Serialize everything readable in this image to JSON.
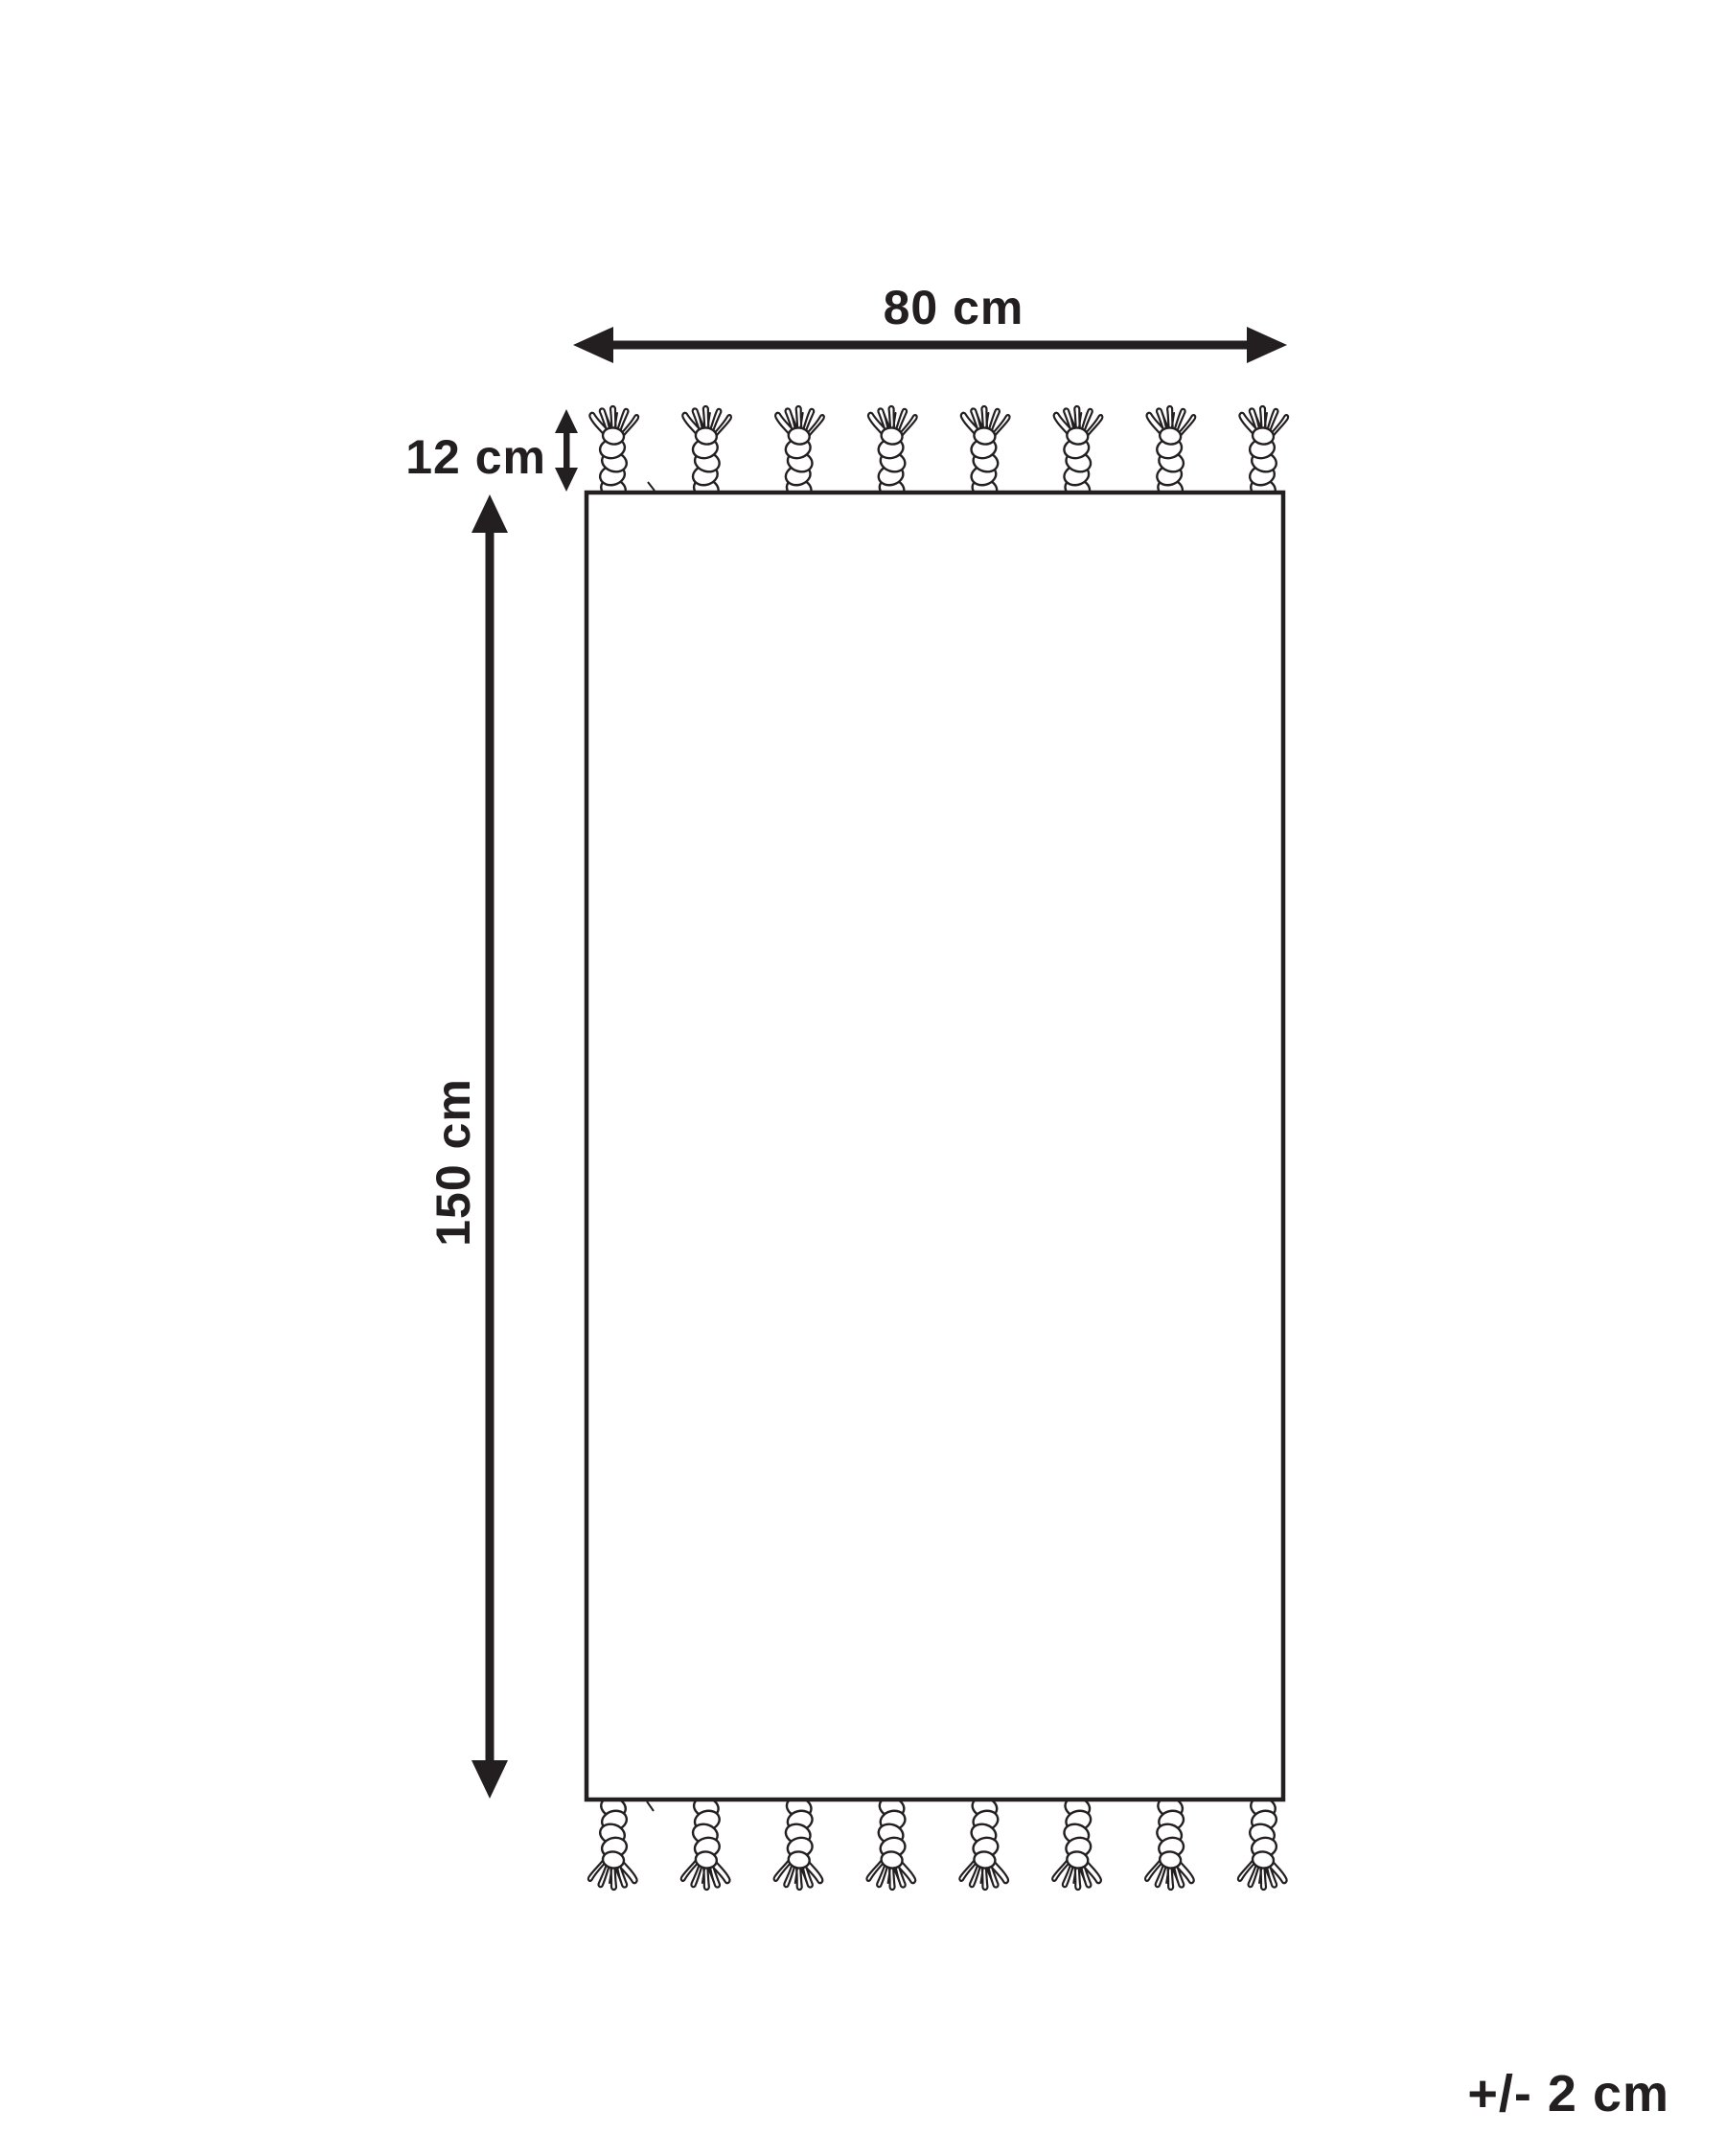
{
  "diagram": {
    "type": "rug-dimension-diagram",
    "labels": {
      "width": "80 cm",
      "fringe": "12 cm",
      "height": "150 cm",
      "tolerance": "+/- 2 cm"
    },
    "dimensions": {
      "width_cm": 80,
      "fringe_cm": 12,
      "height_cm": 150,
      "tolerance_cm": 2
    },
    "tassels": {
      "top_count": 8,
      "bottom_count": 8
    },
    "colors": {
      "ink": "#231f20",
      "background": "#ffffff",
      "rug_fill": "#ffffff"
    }
  }
}
